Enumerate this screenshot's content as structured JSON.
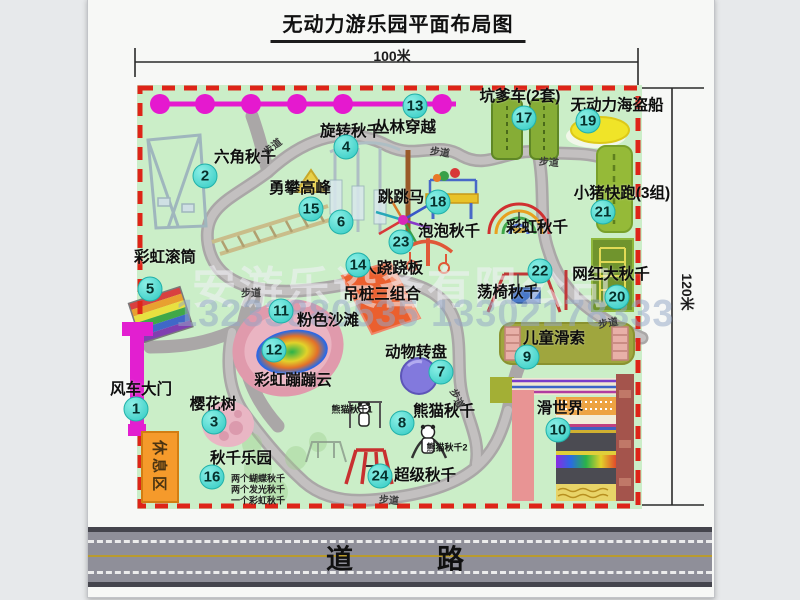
{
  "title": "无动力游乐园平面布局图",
  "dimensions": {
    "top": "100米",
    "right": "120米"
  },
  "road_label": "道　　路",
  "rest_area_label": "休息区",
  "watermark": {
    "company": "安游乐设备有限公司",
    "phone": "13233880535 13302178333"
  },
  "attractions": [
    {
      "num": "1",
      "label": "风车大门",
      "nx": 136,
      "ny": 409,
      "lx": 141,
      "ly": 388
    },
    {
      "num": "2",
      "label": "六角秋千",
      "nx": 205,
      "ny": 176,
      "lx": 245,
      "ly": 156
    },
    {
      "num": "3",
      "label": "樱花树",
      "nx": 214,
      "ny": 422,
      "lx": 213,
      "ly": 403
    },
    {
      "num": "4",
      "label": "旋转秋千",
      "nx": 346,
      "ny": 147,
      "lx": 351,
      "ly": 130
    },
    {
      "num": "5",
      "label": "彩虹滚筒",
      "nx": 150,
      "ny": 289,
      "lx": 165,
      "ly": 256
    },
    {
      "num": "6",
      "label": "6人跷跷板",
      "nx": 341,
      "ny": 222,
      "lx": 388,
      "ly": 267
    },
    {
      "num": "7",
      "label": "动物转盘",
      "nx": 441,
      "ny": 372,
      "lx": 416,
      "ly": 351
    },
    {
      "num": "8",
      "label": "熊猫秋千",
      "nx": 402,
      "ny": 423,
      "lx": 444,
      "ly": 410
    },
    {
      "num": "9",
      "label": "儿童滑索",
      "nx": 527,
      "ny": 357,
      "lx": 554,
      "ly": 337
    },
    {
      "num": "10",
      "label": "滑世界",
      "nx": 558,
      "ny": 430,
      "lx": 560,
      "ly": 407
    },
    {
      "num": "11",
      "label": "粉色沙滩",
      "nx": 281,
      "ny": 311,
      "lx": 328,
      "ly": 319
    },
    {
      "num": "12",
      "label": "彩虹蹦蹦云",
      "nx": 274,
      "ny": 350,
      "lx": 293,
      "ly": 379
    },
    {
      "num": "13",
      "label": "丛林穿越",
      "nx": 415,
      "ny": 106,
      "lx": 405,
      "ly": 126
    },
    {
      "num": "14",
      "label": "吊桩三组合",
      "nx": 358,
      "ny": 265,
      "lx": 382,
      "ly": 293
    },
    {
      "num": "15",
      "label": "勇攀高峰",
      "nx": 311,
      "ny": 209,
      "lx": 300,
      "ly": 187
    },
    {
      "num": "16",
      "label": "秋千乐园",
      "nx": 212,
      "ny": 477,
      "lx": 241,
      "ly": 457
    },
    {
      "num": "17",
      "label": "坑爹车(2套)",
      "nx": 524,
      "ny": 118,
      "lx": 520,
      "ly": 95
    },
    {
      "num": "18",
      "label": "跳跳马",
      "nx": 438,
      "ny": 202,
      "lx": 401,
      "ly": 196
    },
    {
      "num": "19",
      "label": "无动力海盗船",
      "nx": 588,
      "ny": 121,
      "lx": 617,
      "ly": 104
    },
    {
      "num": "20",
      "label": "网红大秋千",
      "nx": 617,
      "ny": 297,
      "lx": 611,
      "ly": 273
    },
    {
      "num": "21",
      "label": "小猪快跑(3组)",
      "nx": 603,
      "ny": 212,
      "lx": 622,
      "ly": 192
    },
    {
      "num": "22",
      "label": "荡椅秋千",
      "nx": 540,
      "ny": 271,
      "lx": 508,
      "ly": 291
    },
    {
      "num": "23",
      "label": "泡泡秋千",
      "nx": 401,
      "ny": 242,
      "lx": 449,
      "ly": 230
    },
    {
      "num": "24",
      "label": "超级秋千",
      "nx": 380,
      "ny": 476,
      "lx": 425,
      "ly": 474
    },
    {
      "num": "",
      "label": "彩虹秋千",
      "nx": 0,
      "ny": 0,
      "lx": 537,
      "ly": 226
    }
  ],
  "sub_labels": [
    {
      "text": "熊猫秋千1",
      "x": 352,
      "y": 409
    },
    {
      "text": "熊猫秋千2",
      "x": 447,
      "y": 447
    }
  ],
  "swing_notes": {
    "x": 231,
    "lines": [
      {
        "text": "两个蝴蝶秋千",
        "y": 478
      },
      {
        "text": "两个发光秋千",
        "y": 489
      },
      {
        "text": "一个彩虹秋千",
        "y": 500
      }
    ]
  },
  "path_labels": [
    {
      "text": "步道",
      "x": 272,
      "y": 146,
      "r": -38
    },
    {
      "text": "步道",
      "x": 440,
      "y": 151,
      "r": 8
    },
    {
      "text": "步道",
      "x": 549,
      "y": 161,
      "r": 5
    },
    {
      "text": "步道",
      "x": 251,
      "y": 292,
      "r": 0
    },
    {
      "text": "步道",
      "x": 608,
      "y": 322,
      "r": -10
    },
    {
      "text": "步道",
      "x": 458,
      "y": 398,
      "r": 65
    },
    {
      "text": "步道",
      "x": 389,
      "y": 499,
      "r": 5
    }
  ]
}
